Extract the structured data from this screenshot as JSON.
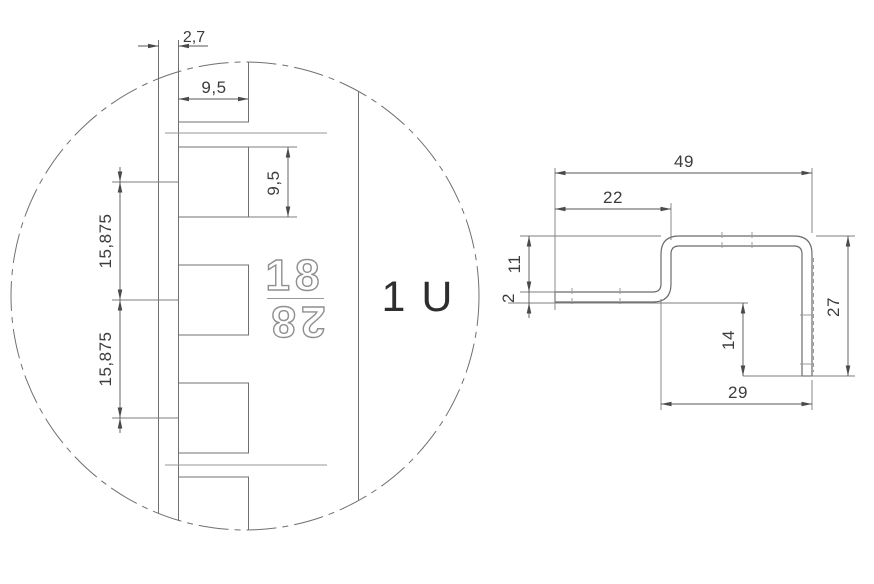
{
  "detail_view": {
    "unit_label": "1 U",
    "marking_top": "18",
    "marking_bottom": "28",
    "dim_flange_offset": "2,7",
    "dim_hole_width": "9,5",
    "dim_hole_height": "9,5",
    "dim_hole_pitch_upper": "15,875",
    "dim_hole_pitch_lower": "15,875"
  },
  "profile_view": {
    "dim_total_width": "49",
    "dim_step_width": "22",
    "dim_step_height": "11",
    "dim_thickness": "2",
    "dim_overall_height": "27",
    "dim_leg_height": "14",
    "dim_bottom_width": "29"
  },
  "colors": {
    "line": "#6a6a6a",
    "dimension": "#3c3c3c",
    "background": "#ffffff"
  }
}
